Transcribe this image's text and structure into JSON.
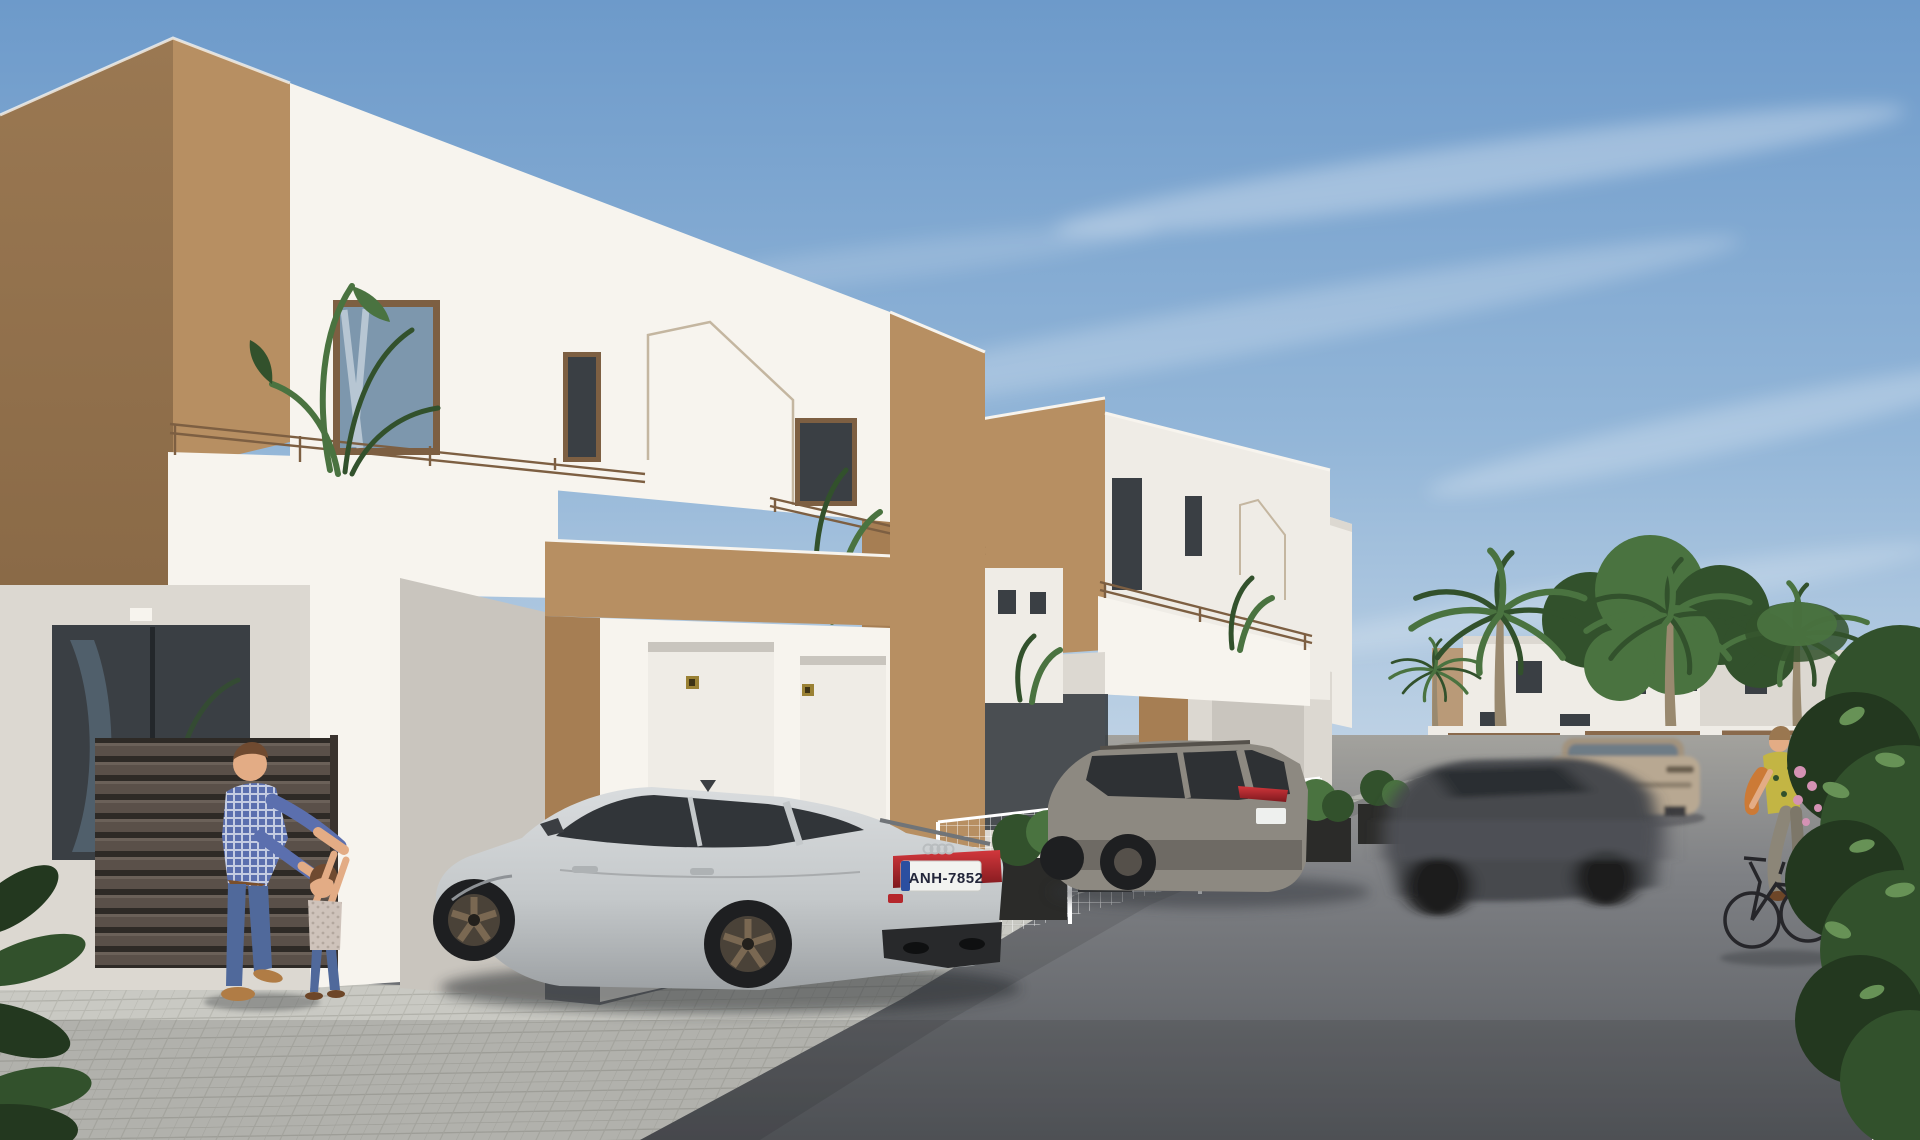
{
  "scene": {
    "type": "architectural-3d-render",
    "description": "Sunny Mediterranean street of new-build two-storey white and tan townhouses; a silver Audi sportback and a grey SUV are parked by the houses, a grey sedan drives past with motion blur, a beige crossover drives away, a man plays with a small child on the pavement, a woman cycles past palm trees and a large green hedge.",
    "houses_visible": 3,
    "cars": [
      "silver audi sportback (parked)",
      "grey suv (parked)",
      "grey sedan (moving, blurred)",
      "beige crossover (driving away)"
    ],
    "people": [
      "man",
      "child",
      "woman on bicycle"
    ],
    "vegetation": [
      "balcony banana plant",
      "palm trees",
      "background leafy tree",
      "foreground hedge",
      "planter shrubs"
    ],
    "audi": {
      "plate_text": "ANH-7852"
    }
  },
  "palette": {
    "sky_top": "#6d9aca",
    "sky_mid": "#93b6d8",
    "sky_low": "#c6d7e7",
    "white_lit": "#f7f4ee",
    "white_mid": "#efece6",
    "white_shade": "#dcd8d1",
    "white_dark": "#c9c5be",
    "brown_lit": "#b78f62",
    "brown_mid": "#a67e53",
    "brown_dark": "#8f6c47",
    "brown_deep": "#7c5d3e",
    "frame": "#7d5f42",
    "glass_dark": "#3a3f44",
    "glass_blue": "#7d97ad",
    "paver": "#c9c9c3",
    "paver_line": "#b1b1aa",
    "asphalt_far": "#a3a29d",
    "asphalt": "#7e8084",
    "asphalt_near": "#55585d",
    "fence_dark": "#433c36",
    "slat": "#635950",
    "green_deep": "#23381f",
    "green_dark": "#32512c",
    "green_mid": "#4a7340",
    "green_light": "#679256",
    "palm_trunk": "#99896f",
    "silver": "#cfd3d5",
    "silver_dark": "#a7abae",
    "silver_deep": "#7e8286",
    "suv_gray": "#8d8981",
    "suv_dark": "#66625c",
    "blur_car": "#47494d",
    "beige_car": "#b8a892",
    "tail_red": "#b5272c",
    "wheel": "#1e1f21",
    "bronze": "#7a685280",
    "skin": "#e3ac85",
    "hair": "#6f4a30",
    "shirt": "#5b6fae",
    "jeans": "#50699b",
    "shoe": "#b07c45",
    "top_yellow": "#c3b544",
    "bag_orange": "#cc7a36",
    "pants": "#8c8678",
    "gold": "#9a8134"
  }
}
